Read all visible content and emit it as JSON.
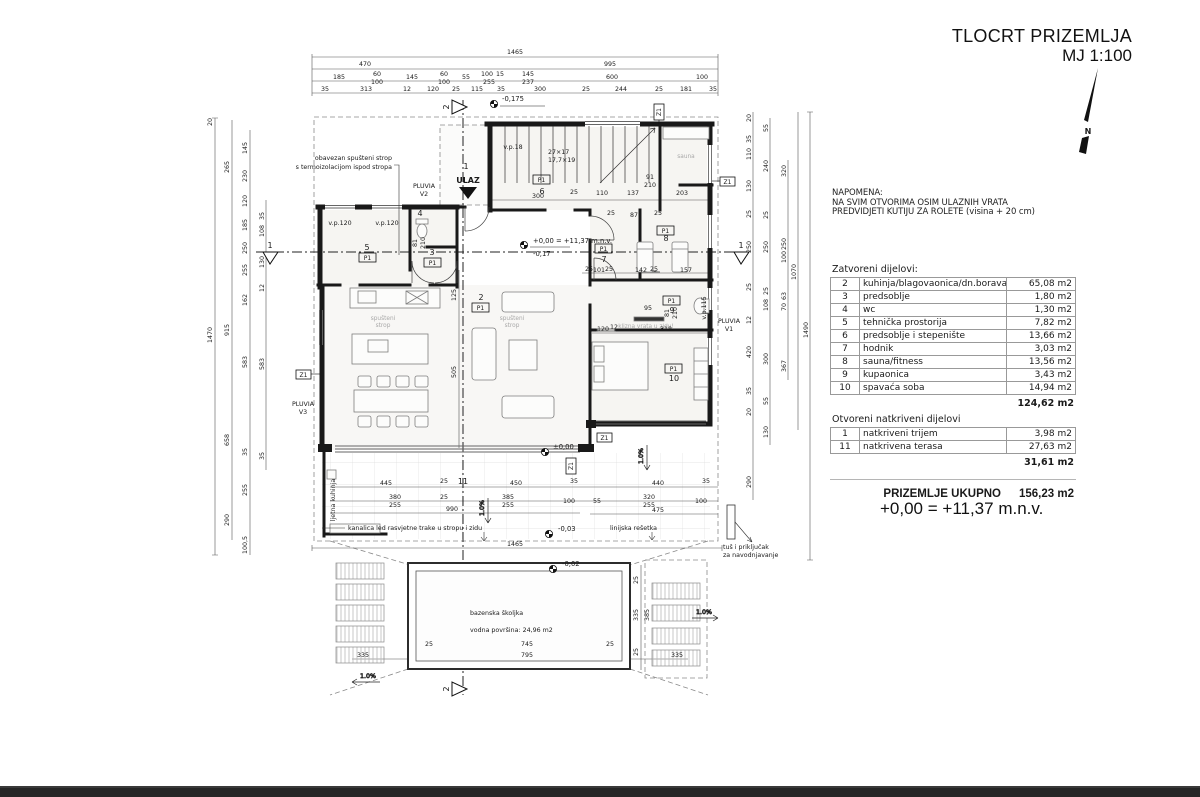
{
  "header": {
    "title": "TLOCRT PRIZEMLJA",
    "scale": "MJ 1:100",
    "north": "N"
  },
  "note": {
    "heading": "NAPOMENA:",
    "line1": "NA SVIM OTVORIMA OSIM ULAZNIH VRATA",
    "line2": "PREDVIDJETI KUTIJU ZA ROLETE (visina + 20 cm)"
  },
  "areas": {
    "closed_heading": "Zatvoreni dijelovi:",
    "closed": [
      {
        "num": "2",
        "name": "kuhinja/blagovaonica/dn.boravak",
        "area": "65,08 m2"
      },
      {
        "num": "3",
        "name": "predsoblje",
        "area": "1,80 m2"
      },
      {
        "num": "4",
        "name": "wc",
        "area": "1,30 m2"
      },
      {
        "num": "5",
        "name": "tehnička prostorija",
        "area": "7,82 m2"
      },
      {
        "num": "6",
        "name": "predsoblje i stepenište",
        "area": "13,66 m2"
      },
      {
        "num": "7",
        "name": "hodnik",
        "area": "3,03 m2"
      },
      {
        "num": "8",
        "name": "sauna/fitness",
        "area": "13,56 m2"
      },
      {
        "num": "9",
        "name": "kupaonica",
        "area": "3,43 m2"
      },
      {
        "num": "10",
        "name": "spavaća soba",
        "area": "14,94 m2"
      }
    ],
    "closed_total": "124,62 m2",
    "open_heading": "Otvoreni natkriveni dijelovi",
    "open": [
      {
        "num": "1",
        "name": "natkriveni trijem",
        "area": "3,98 m2"
      },
      {
        "num": "11",
        "name": "natkrivena terasa",
        "area": "27,63 m2"
      }
    ],
    "open_total": "31,61 m2",
    "summary_label": "PRIZEMLJE UKUPNO",
    "summary_value": "156,23 m2"
  },
  "datum": "+0,00 = +11,37 m.n.v.",
  "plan": {
    "rooms": {
      "r1": "1",
      "r2": "2",
      "r3": "3",
      "r4": "4",
      "r5": "5",
      "r6": "6",
      "r7": "7",
      "r8": "8",
      "r9": "9",
      "r10": "10",
      "r11": "11",
      "tag": "P1"
    },
    "levels": {
      "minus175": "-0,175",
      "datum_line": "+0,00 = +11,37 m.n.v.",
      "minus017": "-0,17",
      "zero": "±0,00",
      "minus003": "-0,03",
      "minus002": "-0,02"
    },
    "slope": "1.0%",
    "marks": {
      "z1": "Z1",
      "s1": "1",
      "s2": "2",
      "ulaz": "ULAZ",
      "pluvia": "PLUVIA",
      "v1": "V1",
      "v2": "V2",
      "v3": "V3"
    },
    "ann": {
      "ceiling1": "obavezan spušteni strop",
      "ceiling2": "s termoizolacijom ispod stropa",
      "kanalica": "kanalica led rasvjetne trake u stropu i zidu",
      "linijska": "linijska rešetka",
      "tus1": "tuš i priključak",
      "tus2": "za navodnjavanje",
      "ljetna": "ljetna kuhinja",
      "pool1": "bazenska školjka",
      "pool2": "vodna površina: 24,96 m2",
      "ceiling_gray1": "spušteni",
      "ceiling_gray2": "strop",
      "sauna_gray": "sauna",
      "klizna": "klizna vrata u zidu!",
      "vp120": "v.p.120",
      "vp18": "v.p.18",
      "vp115": "v.p.115",
      "stair1": "27×17",
      "stair2": "17,7×19"
    },
    "dims": {
      "t1": [
        "1465"
      ],
      "t2": [
        "470",
        "995"
      ],
      "t3": [
        "185",
        "60",
        "100",
        "145",
        "60",
        "100",
        "55",
        "100",
        "15",
        "255",
        "145",
        "237",
        "600",
        "100"
      ],
      "t4": [
        "35",
        "313",
        "12",
        "120",
        "25",
        "115",
        "35",
        "300",
        "25",
        "244",
        "25",
        "181",
        "35"
      ],
      "l1": [
        "20",
        "1470"
      ],
      "l2": [
        "265",
        "915",
        "658",
        "290"
      ],
      "l3": [
        "145",
        "230",
        "120",
        "185",
        "250",
        "255",
        "162",
        "583",
        "35",
        "255",
        "100,5"
      ],
      "l4": [
        "35",
        "108",
        "130",
        "12",
        "583",
        "35"
      ],
      "r1": [
        "20",
        "35",
        "110",
        "130",
        "25",
        "250",
        "25",
        "12",
        "420",
        "35",
        "20",
        "290"
      ],
      "r2": [
        "55",
        "240",
        "25",
        "250",
        "25",
        "108",
        "300",
        "55",
        "130"
      ],
      "r3": [
        "320",
        "250",
        "100",
        "63",
        "70",
        "367"
      ],
      "r4": [
        "1070",
        "1490"
      ],
      "b1": [
        "445",
        "25",
        "450",
        "35",
        "440",
        "35"
      ],
      "b2": [
        "380",
        "255",
        "25",
        "385",
        "255",
        "100",
        "55",
        "320",
        "255",
        "100"
      ],
      "b3": [
        "990",
        "475"
      ],
      "b4": [
        "1465"
      ],
      "in1": [
        "300",
        "25",
        "110",
        "137",
        "203",
        "91",
        "210"
      ],
      "in2": [
        "25",
        "87",
        "25",
        "25",
        "101",
        "25",
        "142",
        "25",
        "157"
      ],
      "in3": [
        "95",
        "120",
        "12",
        "318",
        "505",
        "125"
      ],
      "in4": [
        "81",
        "210",
        "81",
        "210"
      ],
      "pool": [
        "25",
        "745",
        "25",
        "795",
        "335",
        "335",
        "25",
        "335",
        "385",
        "25"
      ]
    }
  }
}
